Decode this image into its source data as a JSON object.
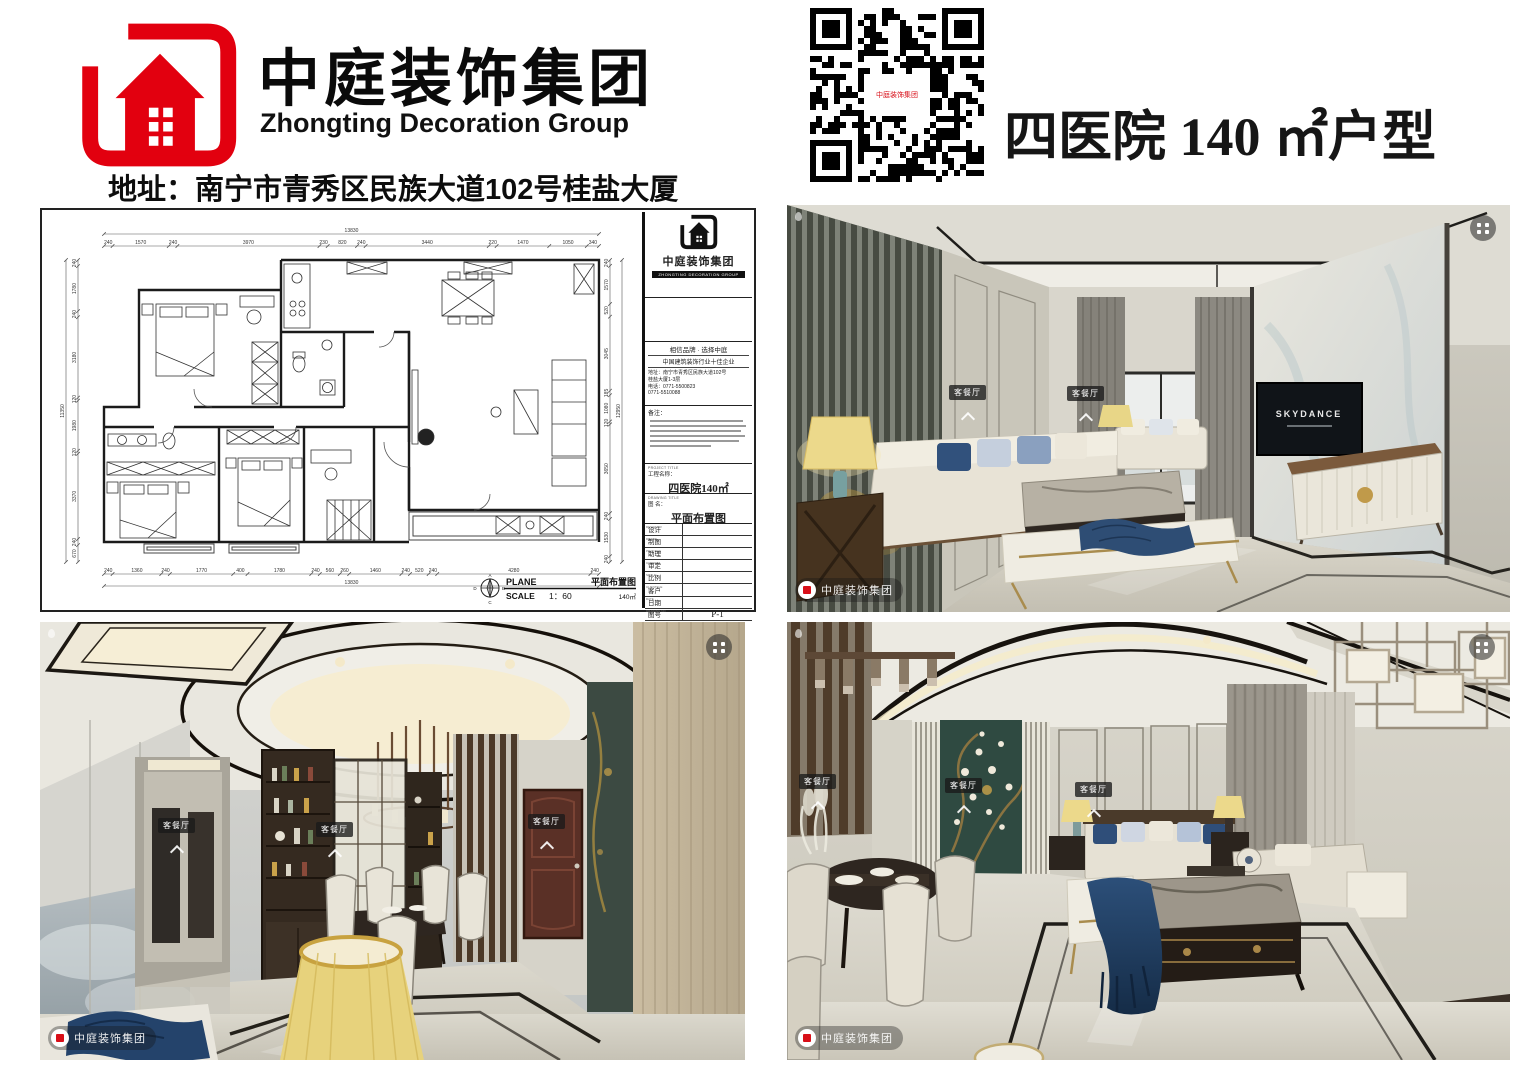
{
  "page": {
    "bg": "#ffffff"
  },
  "brand": {
    "red": "#e2000f",
    "company_cn": "中庭装饰集团",
    "company_en": "Zhongting Decoration Group",
    "address_line": "地址：南宁市青秀区民族大道102号桂盐大厦"
  },
  "unit": {
    "title": "四医院 140 ㎡户型"
  },
  "floorplan": {
    "dims": {
      "top": {
        "total": "13830",
        "segments": [
          240,
          1570,
          240,
          3970,
          230,
          820,
          240,
          3440,
          220,
          1470,
          1050,
          340
        ]
      },
      "bottom": {
        "total": "13830",
        "segments": [
          240,
          1360,
          240,
          1770,
          400,
          1780,
          240,
          560,
          260,
          1460,
          240,
          520,
          240,
          4280,
          240
        ]
      },
      "left": {
        "total": "11350",
        "segments": [
          240,
          1780,
          240,
          3180,
          120,
          1980,
          120,
          3370,
          240,
          670
        ]
      },
      "right": {
        "total": "12950",
        "segments": [
          240,
          1570,
          520,
          3045,
          185,
          1080,
          120,
          3650,
          240,
          1530,
          240
        ]
      }
    },
    "scalebar": {
      "plane": "PLANE",
      "plane_cn": "平面布置图",
      "scale": "SCALE",
      "scale_value": "1：60",
      "area": "140㎡",
      "compass": {
        "n": "A",
        "e": "B",
        "s": "C",
        "w": "D"
      }
    },
    "titleblock": {
      "logo_cn": "中庭装饰集团",
      "logo_strip": "ZHONGTING DECORATION GROUP",
      "slogan1": "相信品牌 · 选择中庭",
      "slogan2": "中国建筑装饰行业十佳企业",
      "address1": "地址：南宁市青秀区民族大道102号",
      "address2": "桂盐大厦1-3层",
      "phone1": "电话：0771-5500823",
      "phone2": "0771-5510088",
      "notes_label": "备注：",
      "project_en": "PROJECT TITLE",
      "project_label": "工程名称：",
      "project_value": "四医院140㎡",
      "drawing_en": "DRAWING TITLE",
      "drawing_label": "图  名：",
      "drawing_value": "平面布置图",
      "rows": [
        {
          "en": "DESIGNER",
          "cn": "设计",
          "value": ""
        },
        {
          "en": "DRAWN",
          "cn": "制图",
          "value": ""
        },
        {
          "en": "PRACTICE",
          "cn": "助理",
          "value": ""
        },
        {
          "en": "CONFIRM",
          "cn": "审定",
          "value": ""
        },
        {
          "en": "SCALE",
          "cn": "比例",
          "value": ""
        },
        {
          "en": "CLIENTELE",
          "cn": "客户",
          "value": ""
        },
        {
          "en": "DATE",
          "cn": "日期",
          "value": ""
        },
        {
          "en": "DRAWING NO",
          "cn": "图号",
          "value": "P-1"
        }
      ],
      "remark_label": "说  明："
    }
  },
  "photos": {
    "room_tag": "客餐厅",
    "watermark": "中庭装饰集团",
    "tv_brand": "SKYDANCE"
  }
}
